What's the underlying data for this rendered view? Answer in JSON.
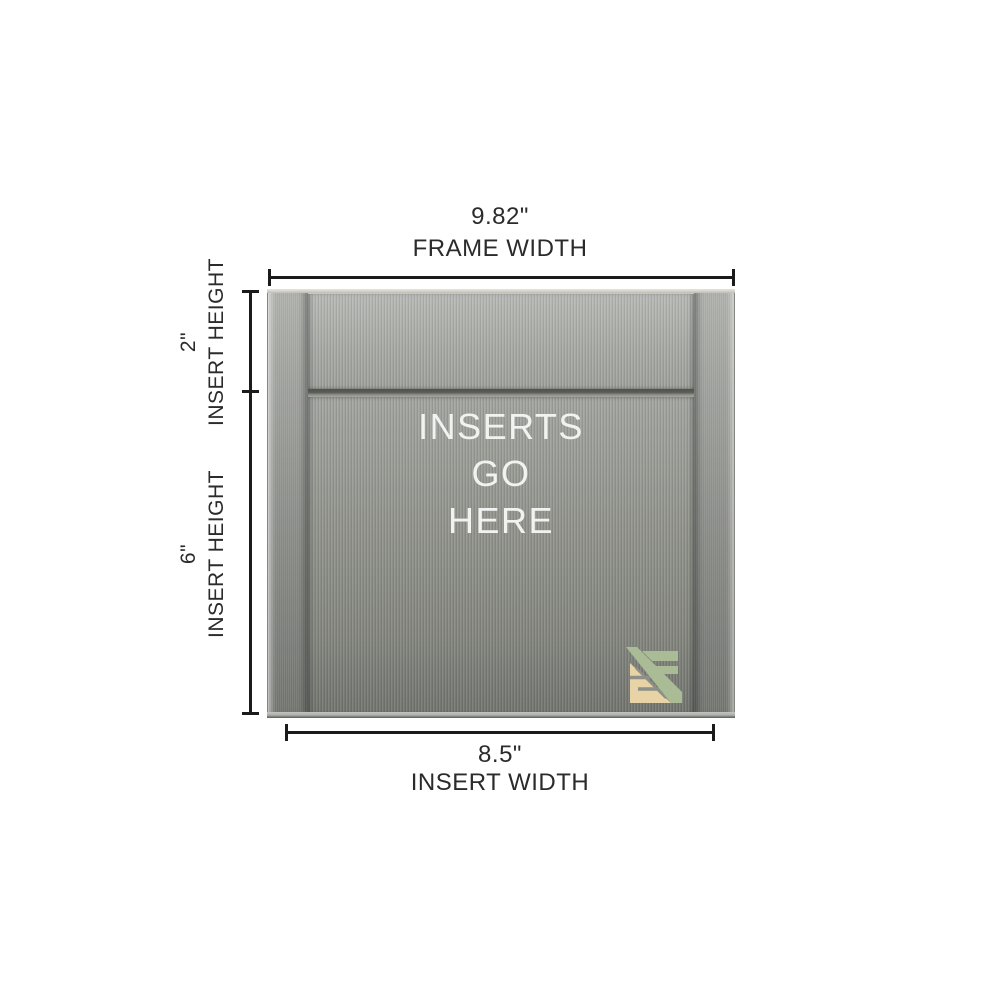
{
  "page": {
    "background": "#ffffff"
  },
  "dimensions": {
    "frame_width": {
      "value": "9.82\"",
      "label": "FRAME WIDTH"
    },
    "top_insert_height": {
      "value": "2\"",
      "label": "INSERT HEIGHT"
    },
    "main_insert_height": {
      "value": "6\"",
      "label": "INSERT HEIGHT"
    },
    "insert_width": {
      "value": "8.5\"",
      "label": "INSERT WIDTH"
    }
  },
  "sign": {
    "insert_text_lines": [
      "INSERTS",
      "GO",
      "HERE"
    ],
    "logo_icon": "sf-monogram",
    "colors": {
      "metal_light": "#b2b4b0",
      "metal_dark": "#747671",
      "divider_rail": "#53564e",
      "insert_text": "#f2f3f1",
      "logo_green": "#a9bc95",
      "logo_tan": "#e7d3a6",
      "dimension_line": "#1b1b1b",
      "dimension_text": "#2b2b2b"
    }
  }
}
